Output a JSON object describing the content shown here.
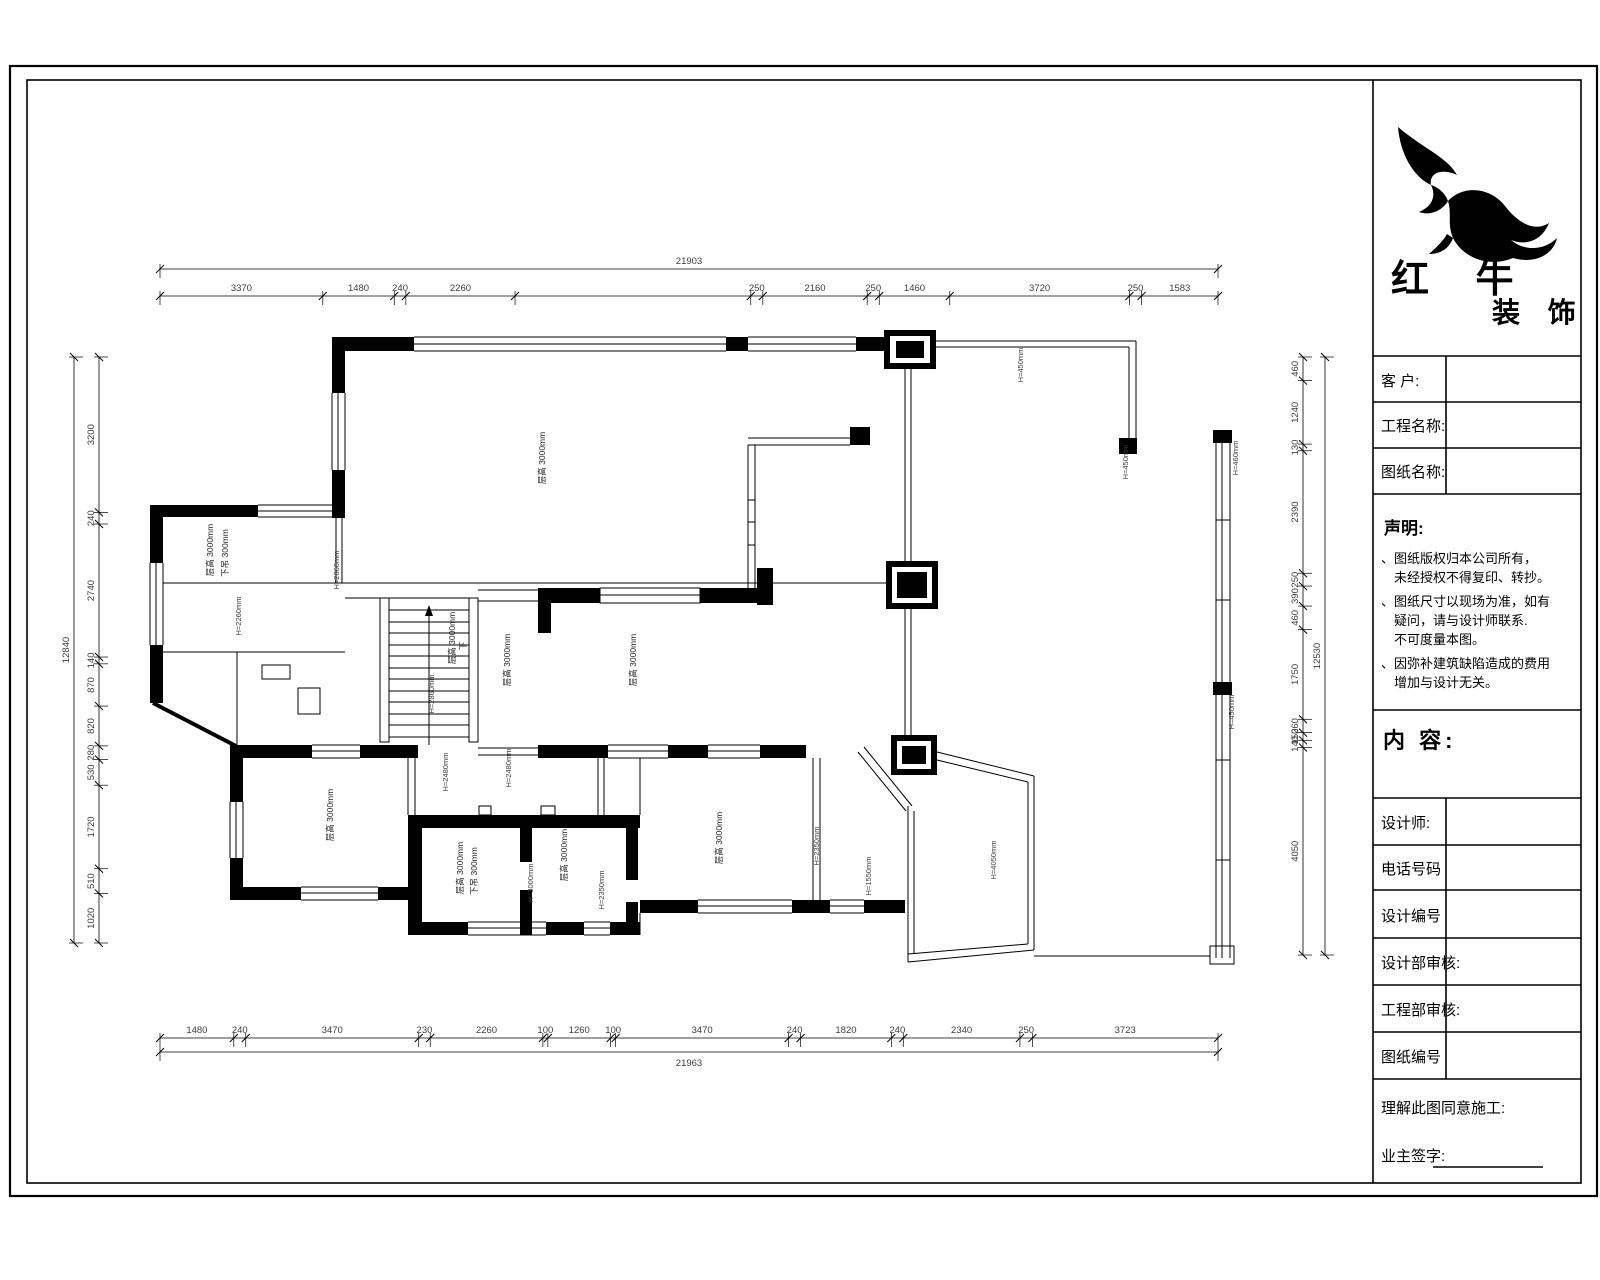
{
  "company": {
    "name": "红 牛",
    "suffix": "装 饰"
  },
  "title_block": {
    "client_label": "客  户:",
    "project_label": "工程名称:",
    "sheet_label": "图纸名称:",
    "statement": {
      "title": "声明:",
      "lines": [
        "、图纸版权归本公司所有，",
        "　未经授权不得复印、转抄。",
        "、图纸尺寸以现场为准，如有",
        "　疑问，请与设计师联系.",
        "　不可度量本图。",
        "、因弥补建筑缺陷造成的费用",
        "　增加与设计无关。"
      ]
    },
    "content_label": "内 容:",
    "designer_label": "设计师:",
    "phone_label": "电话号码",
    "design_no_label": "设计编号",
    "design_review_label": "设计部审核:",
    "eng_review_label": "工程部审核:",
    "sheet_no_label": "图纸编号",
    "agree_label": "理解此图同意施工:",
    "sign_label": "业主签字:"
  },
  "dims": {
    "top_total": {
      "values": [
        21903
      ],
      "labels": [
        "21903"
      ]
    },
    "top": {
      "values": [
        3370,
        1480,
        240,
        2260,
        4880,
        250,
        2160,
        250,
        1460,
        3720,
        250,
        1583
      ],
      "labels": [
        "3370",
        "1480",
        "240",
        "2260",
        "",
        "250",
        "2160",
        "250",
        "1460",
        "3720",
        "250",
        "1583"
      ]
    },
    "bottom": {
      "values": [
        1480,
        240,
        3470,
        230,
        2260,
        100,
        1260,
        100,
        3470,
        240,
        1820,
        240,
        2340,
        250,
        3723
      ],
      "labels": [
        "1480",
        "240",
        "3470",
        "230",
        "2260",
        "100",
        "1260",
        "100",
        "3470",
        "240",
        "1820",
        "240",
        "2340",
        "250",
        "3723"
      ]
    },
    "bottom_total": {
      "values": [
        21963
      ],
      "labels": [
        "21963"
      ]
    },
    "left": {
      "values": [
        3200,
        240,
        2740,
        140,
        870,
        820,
        280,
        530,
        1720,
        510,
        1020
      ],
      "labels": [
        "3200",
        "240",
        "2740",
        "140",
        "870",
        "820",
        "280",
        "530",
        "1720",
        "510",
        "1020"
      ]
    },
    "left_total": {
      "values": [
        12840
      ],
      "labels": [
        "12840"
      ]
    },
    "right": {
      "values": [
        460,
        1240,
        130,
        2390,
        250,
        390,
        460,
        1750,
        260,
        150,
        140,
        4050
      ],
      "labels": [
        "460",
        "1240",
        "130",
        "2390",
        "250",
        "390",
        "460",
        "1750",
        "260",
        "150",
        "140",
        "4050"
      ]
    },
    "right_total": {
      "values": [
        12530
      ],
      "labels": [
        "12530"
      ]
    }
  },
  "plan": {
    "room_labels": [
      "层高 3000mm",
      "层高 3000mm",
      "下吊 300mm",
      "层高 3000mm",
      "层高 3000mm",
      "层高 3000mm",
      "层高 3000mm",
      "层高 3000mm",
      "下吊 300mm",
      "层高 3000mm",
      "层高 3000mm"
    ],
    "annotations": [
      "H=450mm",
      "H=450mm",
      "H=460mm",
      "H=450mm",
      "H=2860mm",
      "H=2260mm",
      "H=2860mm",
      "H=2480mm",
      "H=2480mm",
      "H=3000mm",
      "H=2350mm",
      "H=1550mm",
      "H=4050mm",
      "H=2350mm"
    ],
    "stair_label": "下"
  },
  "colors": {
    "line": "#000000",
    "dim_text": "#3c3c3c",
    "paper": "#ffffff"
  }
}
